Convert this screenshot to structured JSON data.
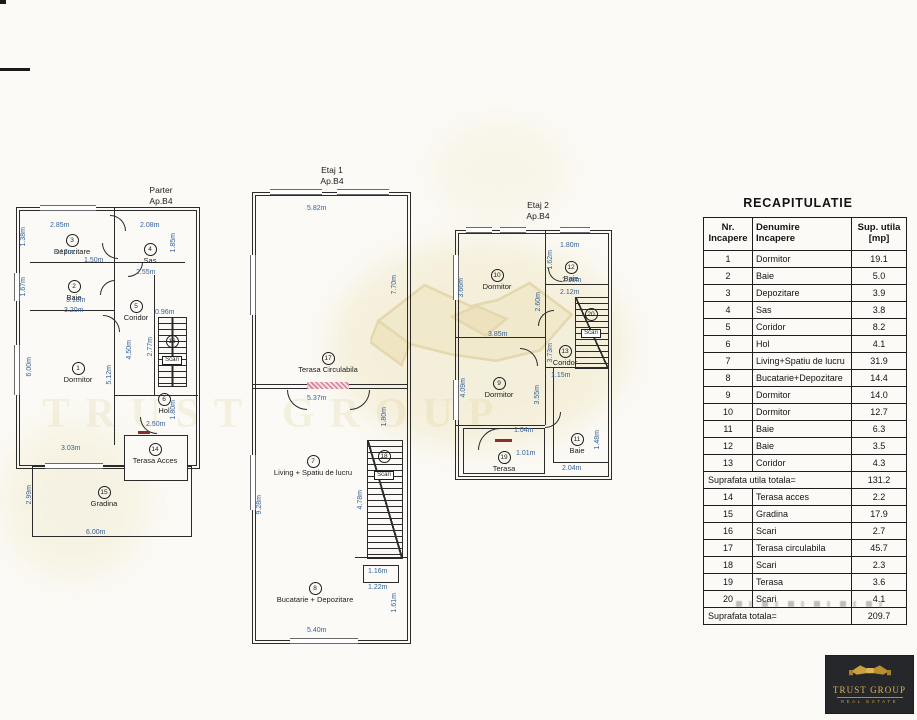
{
  "watermark": {
    "text": "TRUST GROUP"
  },
  "plans": {
    "parter": {
      "title": "Parter",
      "ap": "Ap.B4",
      "rooms": {
        "r1": {
          "num": "1",
          "name": "Dormitor"
        },
        "r2": {
          "num": "2",
          "name": "Baie"
        },
        "r3": {
          "num": "3",
          "name": "Depozitare"
        },
        "r4": {
          "num": "4",
          "name": "Sas"
        },
        "r5": {
          "num": "5",
          "name": "Coridor"
        },
        "r6": {
          "num": "6",
          "name": "Hol"
        },
        "r14": {
          "num": "14",
          "name": "Terasa Acces"
        },
        "r15": {
          "num": "15",
          "name": "Gradina"
        },
        "r16": {
          "num": "16",
          "name": "Scari"
        }
      },
      "dims": {
        "dep_w": "2.85m",
        "dep_w2": "3.17m",
        "dep_h": "1.38m",
        "sas_w": "2.08m",
        "sas_h": "1.85m",
        "baie_w": "1.50m",
        "baie_h": "1.67m",
        "baie_w2": "3.18m",
        "cor_w": "2.55m",
        "cor_h": "4.50m",
        "dor_w": "3.20m",
        "dor_h": "6.00m",
        "dor_h2": "5.12m",
        "dor_w2": "3.03m",
        "scari_w": "0.96m",
        "scari_h": "2.77m",
        "hol_h": "1.80m",
        "hol_w": "2.50m",
        "gra_h": "2.99m",
        "gra_w": "6.00m"
      }
    },
    "etaj1": {
      "title": "Etaj 1",
      "ap": "Ap.B4",
      "rooms": {
        "r17": {
          "num": "17",
          "name": "Terasa Circulabila"
        },
        "r7": {
          "num": "7",
          "name": "Living + Spatiu de lucru"
        },
        "r8": {
          "num": "8",
          "name": "Bucatarie + Depozitare"
        },
        "r18": {
          "num": "18",
          "name": "Scari"
        }
      },
      "dims": {
        "ter_w": "5.82m",
        "ter_h": "7.70m",
        "liv_w": "5.37m",
        "liv_h": "1.80m",
        "liv_h2": "9.28m",
        "scari_h": "4.78m",
        "buc_w2": "1.16m",
        "buc_w3": "1.22m",
        "buc_h": "1.61m",
        "buc_w": "5.40m"
      }
    },
    "etaj2": {
      "title": "Etaj 2",
      "ap": "Ap.B4",
      "rooms": {
        "r9": {
          "num": "9",
          "name": "Dormitor"
        },
        "r10": {
          "num": "10",
          "name": "Dormitor"
        },
        "r11": {
          "num": "11",
          "name": "Baie"
        },
        "r12": {
          "num": "12",
          "name": "Baie"
        },
        "r13": {
          "num": "13",
          "name": "Coridor"
        },
        "r19": {
          "num": "19",
          "name": "Terasa"
        },
        "r20": {
          "num": "20",
          "name": "Scari"
        }
      },
      "dims": {
        "dor10_h": "3.66m",
        "baie12_w": "1.80m",
        "baie12_h": "1.62m",
        "baie12_w2": "2.10m",
        "cor_w": "2.12m",
        "wall_h": "2.60m",
        "dor9_w": "3.85m",
        "dor9_h": "4.09m",
        "dor9_h2": "3.55m",
        "cor_h": "3.73m",
        "cor_w2": "1.15m",
        "ter_w": "1.04m",
        "ter_w2": "1.01m",
        "baie11_h": "1.48m",
        "baie11_w": "2.04m"
      }
    }
  },
  "recap": {
    "title": "RECAPITULATIE",
    "headers": {
      "c1l1": "Nr.",
      "c1l2": "Incapere",
      "c2l1": "Denumire",
      "c2l2": "Incapere",
      "c3l1": "Sup. utila",
      "c3l2": "[mp]"
    },
    "rows": [
      {
        "nr": "1",
        "name": "Dormitor",
        "val": "19.1"
      },
      {
        "nr": "2",
        "name": "Baie",
        "val": "5.0"
      },
      {
        "nr": "3",
        "name": "Depozitare",
        "val": "3.9"
      },
      {
        "nr": "4",
        "name": "Sas",
        "val": "3.8"
      },
      {
        "nr": "5",
        "name": "Coridor",
        "val": "8.2"
      },
      {
        "nr": "6",
        "name": "Hol",
        "val": "4.1"
      },
      {
        "nr": "7",
        "name": "Living+Spatiu de lucru",
        "val": "31.9"
      },
      {
        "nr": "8",
        "name": "Bucatarie+Depozitare",
        "val": "14.4"
      },
      {
        "nr": "9",
        "name": "Dormitor",
        "val": "14.0"
      },
      {
        "nr": "10",
        "name": "Dormitor",
        "val": "12.7"
      },
      {
        "nr": "11",
        "name": "Baie",
        "val": "6.3"
      },
      {
        "nr": "12",
        "name": "Baie",
        "val": "3.5"
      },
      {
        "nr": "13",
        "name": "Coridor",
        "val": "4.3"
      }
    ],
    "subtotal": {
      "label": "Suprafata utila totala=",
      "value": "131.2"
    },
    "rows2": [
      {
        "nr": "14",
        "name": "Terasa acces",
        "val": "2.2"
      },
      {
        "nr": "15",
        "name": "Gradina",
        "val": "17.9"
      },
      {
        "nr": "16",
        "name": "Scari",
        "val": "2.7"
      },
      {
        "nr": "17",
        "name": "Terasa circulabila",
        "val": "45.7"
      },
      {
        "nr": "18",
        "name": "Scari",
        "val": "2.3"
      },
      {
        "nr": "19",
        "name": "Terasa",
        "val": "3.6"
      },
      {
        "nr": "20",
        "name": "Scari",
        "val": "4.1"
      }
    ],
    "total": {
      "label": "Suprafata totala=",
      "value": "209.7"
    }
  },
  "logo": {
    "name": "TRUST GROUP",
    "tagline": "REAL ESTATE"
  }
}
